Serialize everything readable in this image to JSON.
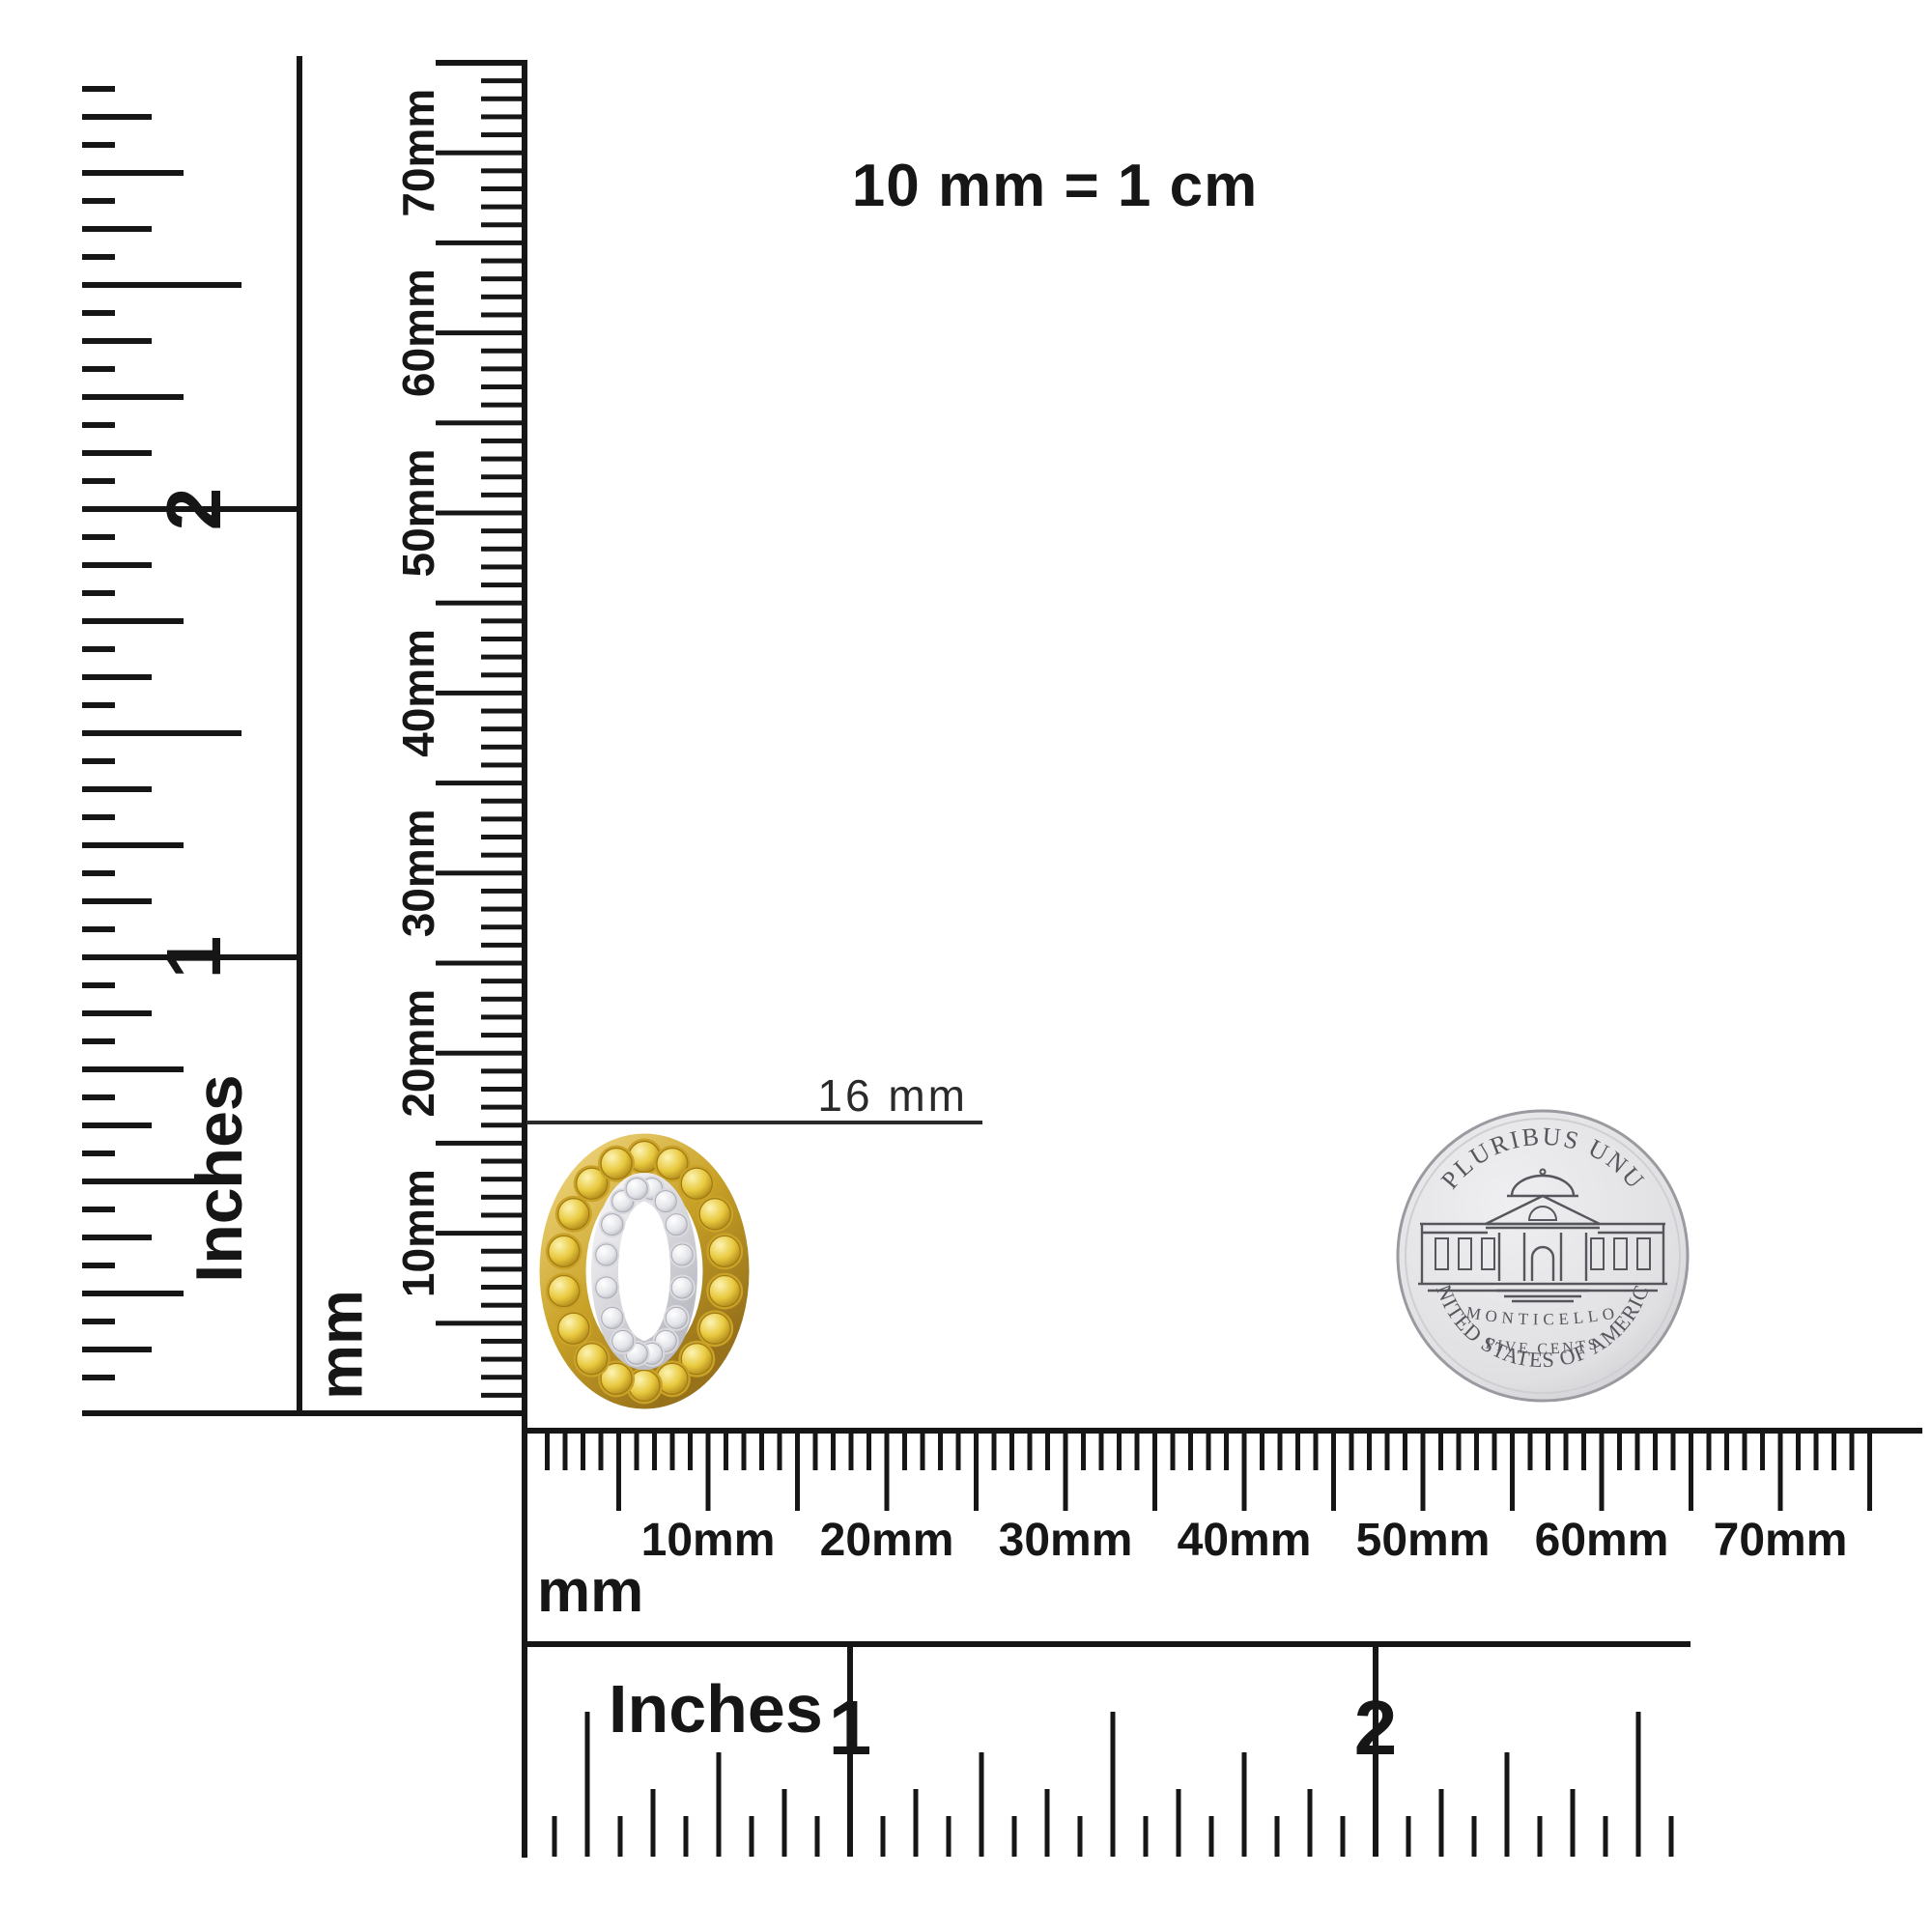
{
  "scale_note": "10 mm = 1 cm",
  "measurement": {
    "label": "16 mm"
  },
  "rulers": {
    "left_inches": {
      "unit": "Inches",
      "numerals": [
        "1",
        "2"
      ]
    },
    "left_mm": {
      "unit": "mm",
      "labels": [
        "10mm",
        "20mm",
        "30mm",
        "40mm",
        "50mm",
        "60mm",
        "70mm"
      ]
    },
    "bottom_mm": {
      "unit": "mm",
      "labels": [
        "10mm",
        "20mm",
        "30mm",
        "40mm",
        "50mm",
        "60mm",
        "70mm"
      ]
    },
    "bottom_inches": {
      "unit": "Inches",
      "numerals": [
        "1",
        "2"
      ]
    }
  },
  "jewelry": {
    "name": "oval halo open-center stud with yellow and white diamonds",
    "outer_stone_color": "#e8c93e",
    "outer_stone_highlight": "#fdf4b5",
    "outer_stone_shadow": "#a87f16",
    "outer_metal_color": "#c9a227",
    "outer_metal_light": "#edd37a",
    "outer_metal_dark": "#97721a",
    "inner_stone_color": "#e3e4e9",
    "inner_stone_highlight": "#ffffff",
    "inner_stone_shadow": "#b2b3bc",
    "inner_metal_color": "#d9d9de",
    "inner_metal_light": "#f6f6f8",
    "inner_metal_dark": "#bcbcc4",
    "outer_stones": 18,
    "inner_stones": 16
  },
  "coin": {
    "name": "Jefferson nickel reverse",
    "top_text": "E PLURIBUS UNUM",
    "building_label": "MONTICELLO",
    "denomination": "FIVE CENTS",
    "bottom_text": "UNITED STATES OF AMERICA",
    "face_color": "#efeff1",
    "face_edge_color": "#c5c5c9",
    "rim_color": "#9a9aa0",
    "inner_rim_color": "#cfcfd3",
    "engraving_color": "#56575d"
  },
  "colors": {
    "ink": "#161616",
    "annotation": "#2a2a2a",
    "white": "#ffffff"
  }
}
